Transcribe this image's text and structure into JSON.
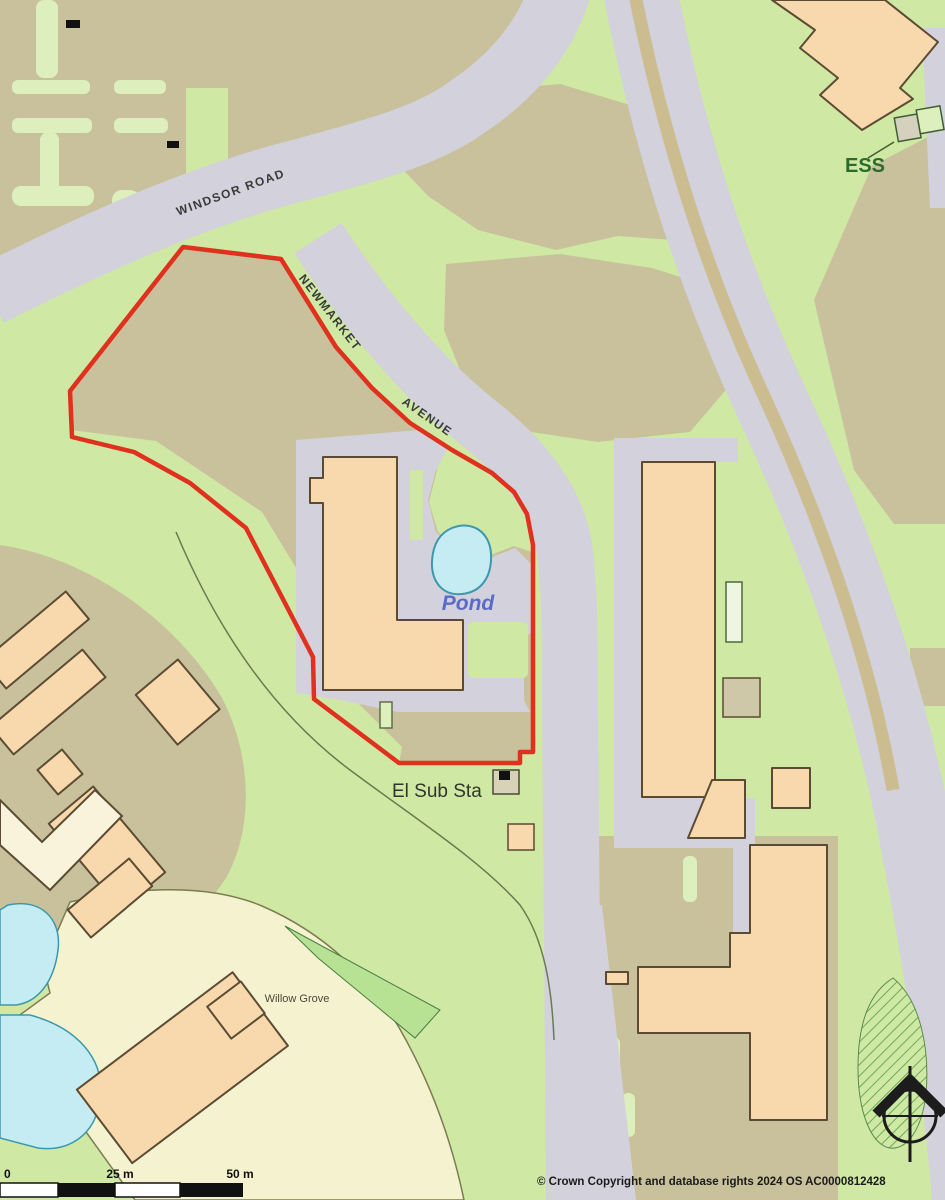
{
  "map": {
    "road_labels": {
      "windsor_road": "WINDSOR ROAD",
      "newmarket": "NEWMARKET",
      "avenue": "AVENUE"
    },
    "feature_labels": {
      "ess": "ESS",
      "pond": "Pond",
      "el_sub_sta": "El Sub Sta",
      "willow_grove": "Willow Grove"
    },
    "scale_bar": {
      "tick_0": "0",
      "tick_25": "25 m",
      "tick_50": "50 m"
    },
    "copyright": "© Crown Copyright and database rights 2024 OS AC0000812428",
    "colors": {
      "boundary_red": "#e0301e",
      "road_gray": "#d3d1dc",
      "building_peach": "#f8d9ae",
      "ground_khaki": "#c8c19c",
      "grass_green": "#cfe9a4",
      "grounds_pale_yellow": "#f5f2cf",
      "water_blue": "#c6ecf3"
    }
  }
}
